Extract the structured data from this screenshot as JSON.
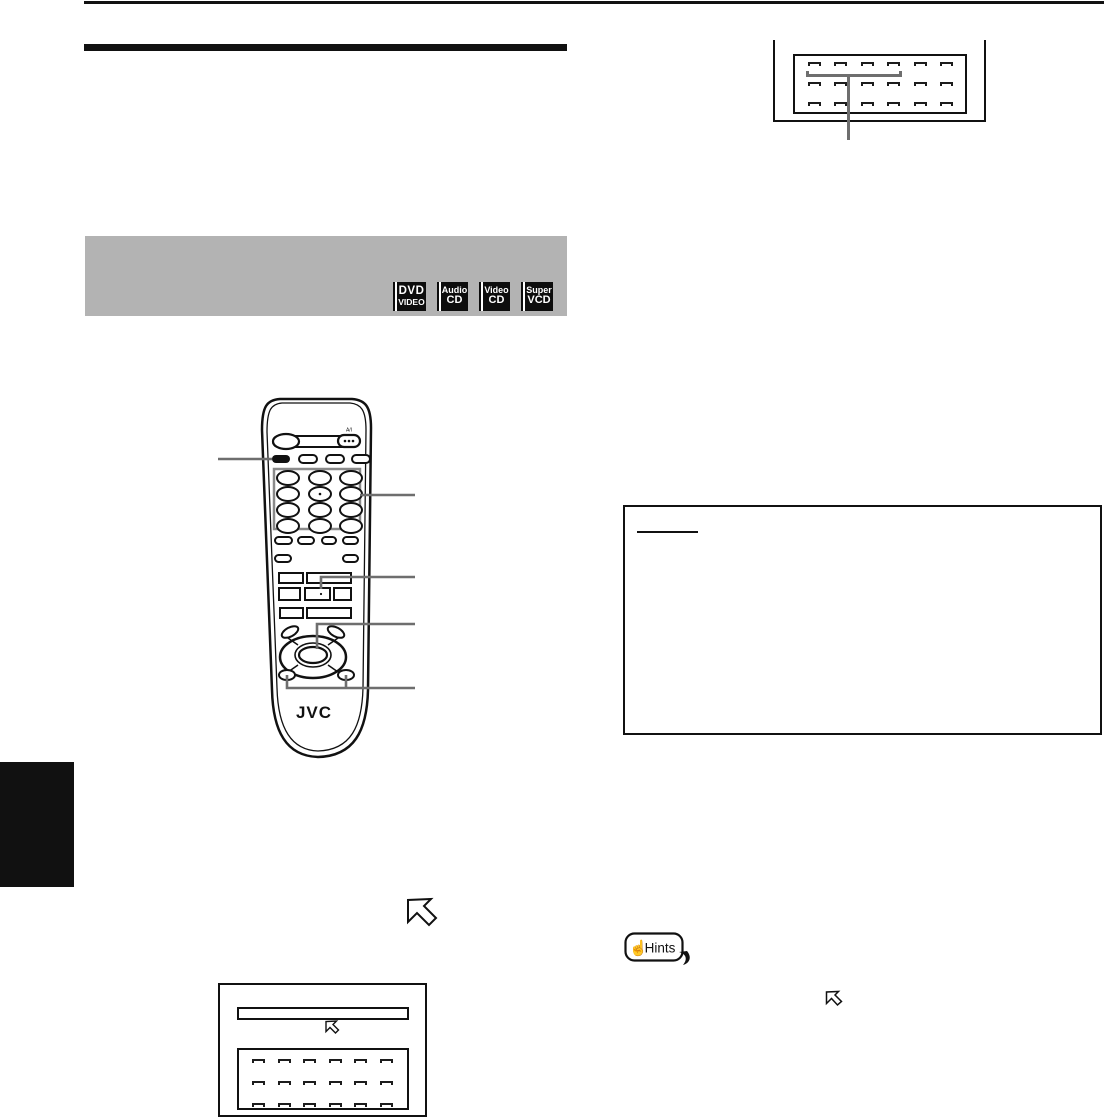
{
  "disc_format_panel": {
    "badges": [
      {
        "line1": "DVD",
        "line2": "VIDEO"
      },
      {
        "line1": "Audio",
        "line2": "CD"
      },
      {
        "line1": "Video",
        "line2": "CD"
      },
      {
        "line1": "Super",
        "line2": "VCD"
      }
    ]
  },
  "remote": {
    "brand": "JVC",
    "top_right_label": "A/I"
  },
  "hints_badge": {
    "label": "Hints",
    "hand_icon": "☝"
  },
  "colors": {
    "ink": "#111111",
    "panel_gray": "#b3b3b3",
    "callout_gray": "#6e6e6e"
  }
}
